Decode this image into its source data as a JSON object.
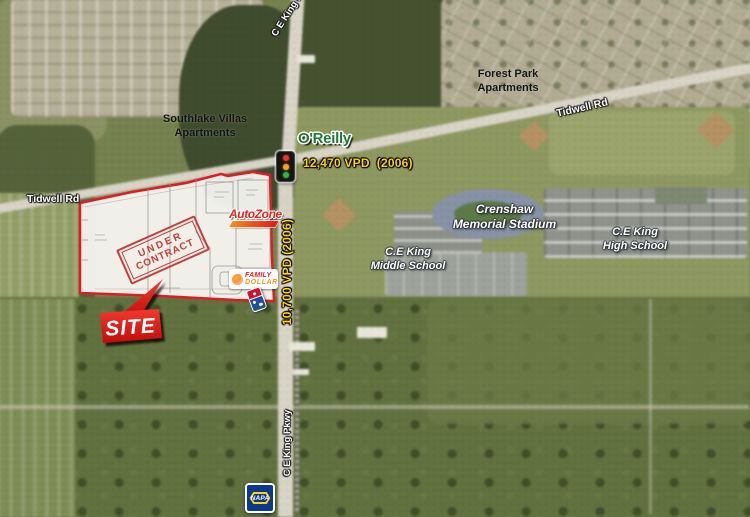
{
  "map": {
    "labels": {
      "southlake": {
        "line1": "Southlake Villas",
        "line2": "Apartments"
      },
      "forest_park": {
        "line1": "Forest Park",
        "line2": "Apartments"
      },
      "crenshaw": {
        "line1": "Crenshaw",
        "line2": "Memorial Stadium"
      },
      "middle_school": {
        "line1": "C.E King",
        "line2": "Middle School"
      },
      "high_school": {
        "line1": "C.E King",
        "line2": "High School"
      }
    },
    "roads": {
      "tidwell_left": "Tidwell Rd",
      "tidwell_right": "Tidwell Rd",
      "ce_king_top": "C E King Pkwy",
      "ce_king_bottom": "C E King Pkwy"
    },
    "traffic": {
      "tidwell_vpd": "12,470 VPD  (2006)",
      "ce_king_vpd": "10,700 VPD (2006)"
    },
    "site": {
      "callout": "SITE",
      "stamp_line1": "UNDER",
      "stamp_line2": "CONTRACT"
    },
    "brands": {
      "oreilly": "O'Reilly",
      "autozone": "AutoZone",
      "family_dollar": {
        "line1": "FAMILY",
        "line2": "DOLLAR"
      },
      "napa": "NAPA"
    },
    "colors": {
      "vpd_text": "#FFD60A",
      "site_red": "#E01B24",
      "stamp": "#C63431",
      "oreilly_green": "#1E7A34",
      "autozone_red": "#E2231A",
      "autozone_orange": "#F68B1F",
      "family_dollar_red": "#ED1C24",
      "family_dollar_orange": "#F7941D",
      "napa_blue": "#0A3A8C",
      "napa_yellow": "#FFD100"
    }
  }
}
